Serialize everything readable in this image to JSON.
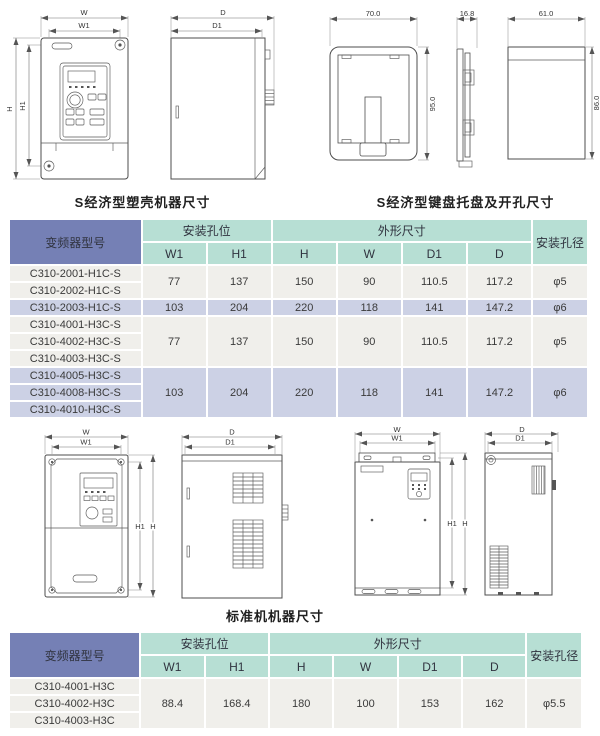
{
  "captions": {
    "s_plastic_machine": "S经济型塑壳机器尺寸",
    "s_keypad_tray": "S经济型键盘托盘及开孔尺寸",
    "standard_machine": "标准机机器尺寸"
  },
  "dims": {
    "W": "W",
    "W1": "W1",
    "H": "H",
    "H1": "H1",
    "D": "D",
    "D1": "D1"
  },
  "tray_dims": {
    "front_width": "70.0",
    "front_height": "95.0",
    "side_depth": "16.8",
    "cutout_width": "61.0",
    "cutout_height": "86.0"
  },
  "table_header": {
    "model": "变频器型号",
    "mounting_holes": "安装孔位",
    "outline_size": "外形尺寸",
    "hole_diameter": "安装孔径",
    "sub_cols": [
      "W1",
      "H1",
      "H",
      "W",
      "D1",
      "D"
    ]
  },
  "table1": {
    "groups": [
      {
        "shade": "light",
        "models": [
          "C310-2001-H1C-S",
          "C310-2002-H1C-S"
        ],
        "values": [
          "77",
          "137",
          "150",
          "90",
          "110.5",
          "117.2",
          "φ5"
        ]
      },
      {
        "shade": "lavender",
        "models": [
          "C310-2003-H1C-S"
        ],
        "values": [
          "103",
          "204",
          "220",
          "118",
          "141",
          "147.2",
          "φ6"
        ]
      },
      {
        "shade": "light",
        "models": [
          "C310-4001-H3C-S",
          "C310-4002-H3C-S",
          "C310-4003-H3C-S"
        ],
        "values": [
          "77",
          "137",
          "150",
          "90",
          "110.5",
          "117.2",
          "φ5"
        ]
      },
      {
        "shade": "lavender",
        "models": [
          "C310-4005-H3C-S",
          "C310-4008-H3C-S",
          "C310-4010-H3C-S"
        ],
        "values": [
          "103",
          "204",
          "220",
          "118",
          "141",
          "147.2",
          "φ6"
        ]
      }
    ]
  },
  "table2": {
    "groups": [
      {
        "shade": "light",
        "models": [
          "C310-4001-H3C",
          "C310-4002-H3C",
          "C310-4003-H3C"
        ],
        "values": [
          "88.4",
          "168.4",
          "180",
          "100",
          "153",
          "162",
          "φ5.5"
        ]
      }
    ]
  },
  "colors": {
    "model_header_bg": "#7580b5",
    "teal_header_bg": "#b7dfd4",
    "row_light_bg": "#f0efeb",
    "row_lavender_bg": "#ccd1e5"
  }
}
